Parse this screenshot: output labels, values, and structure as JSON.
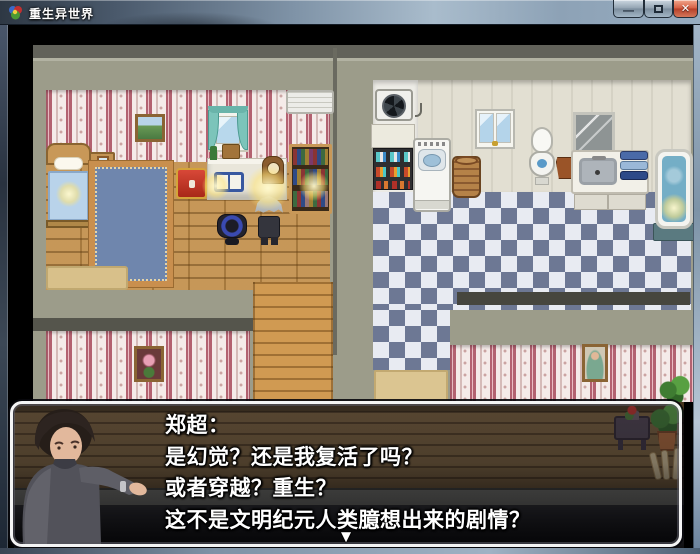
{
  "window": {
    "title": "重生异世界",
    "controls": {
      "minimize_glyph": "—",
      "close_glyph": "✕"
    }
  },
  "dialog": {
    "speaker": "郑超：",
    "lines": [
      "是幻觉？还是我复活了吗？",
      "或者穿越？重生？",
      "这不是文明纪元人类臆想出来的剧情？"
    ],
    "continue_indicator": "▼"
  },
  "scene": {
    "objects": [
      "bed",
      "nightstand",
      "blue-rug",
      "treasure-chest",
      "desk",
      "open-book",
      "clock",
      "bookshelf",
      "air-conditioner",
      "curtain-window",
      "mountain-painting",
      "office-chair",
      "hero-sprite",
      "lamp-glow",
      "ventilation-fan",
      "storage-shelf",
      "washing-machine",
      "laundry-basket",
      "bathroom-window",
      "toilet",
      "clay-pot",
      "mirror",
      "sink-counter",
      "towels",
      "bathtub",
      "doormat",
      "flower-painting",
      "lady-portrait",
      "potted-plant",
      "flower-table",
      "fence-posts"
    ],
    "colors": {
      "wall": "#9c9c8a",
      "wallpaper_stripe": "#c06a7c",
      "wallpaper_base": "#f5ebe9",
      "wood_floor": "#c3914e",
      "corridor_wood": "#d09a52",
      "tile_dark": "#6d7894",
      "tile_light": "#e8ebf2",
      "bathroom_wall": "#e2dfd2",
      "dialog_border": "#f4f4f4",
      "close_button": "#c9573f"
    }
  }
}
